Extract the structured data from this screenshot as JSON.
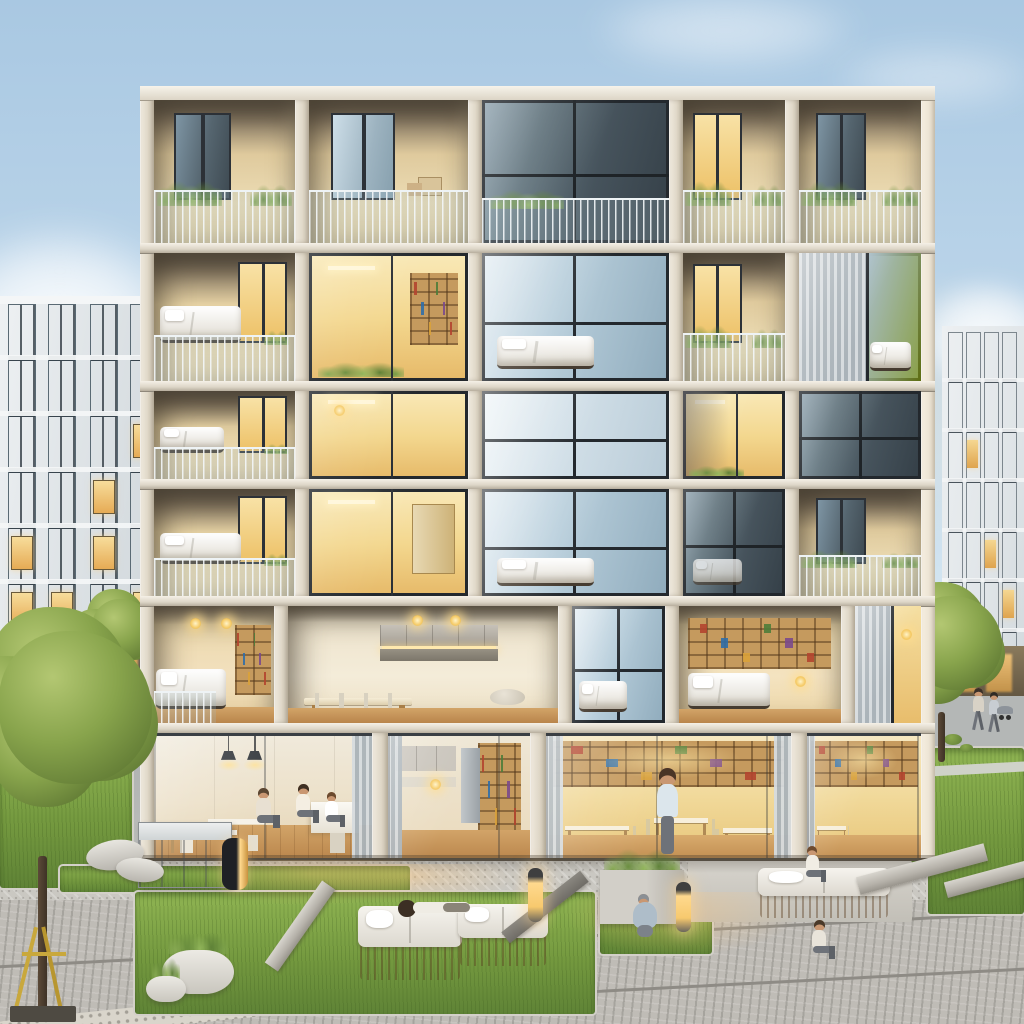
{
  "meta": {
    "description": "Dusk architectural visualization: modular apartment block with lit cutaway interiors, neighbor buildings, plaza with lawns, daybeds, planters and people",
    "canvas": {
      "width": 1024,
      "height": 1024
    }
  },
  "palette": {
    "sky_top": "#a9c8e2",
    "sky_mid": "#c6dcee",
    "sky_horizon": "#e9f1f6",
    "cloud": "#ffffff",
    "concrete_sun": "#f1ebdf",
    "concrete": "#e2dbcd",
    "concrete_shade": "#b9b1a2",
    "slab_edge": "#8f887b",
    "recess_wall": "#e9d7ac",
    "recess_ceiling": "#6a6052",
    "glass_sky": "#bdd2de",
    "glass_dark": "#414e58",
    "frame": "#23282d",
    "warm_light": "#f2d48a",
    "warm_deep": "#e2a74e",
    "lamp_glow": "#ffe2a0",
    "wood": "#c59a5e",
    "wood_dark": "#a87e47",
    "plant": "#6c8f45",
    "plant_light": "#8fae56",
    "grass": "#74993f",
    "grass_bright": "#90b553",
    "paver": "#cac8c2",
    "paver_light": "#d8d5ce",
    "cobble": "#bfbcb6",
    "bed": "#f5f4f0",
    "curtain": "#d6dbde",
    "curtain_dark": "#aab3b9",
    "skin": "#c99772",
    "pants": "#6e7279",
    "book_colors": [
      "#b2452f",
      "#2f6ea8",
      "#d9a23a",
      "#4e7d3a",
      "#7a4a8c",
      "#b2452f"
    ]
  },
  "sky": {
    "clouds": [
      {
        "x": -70,
        "y": 225,
        "w": 260,
        "h": 200,
        "blur": 16,
        "o": 0.95
      },
      {
        "x": -40,
        "y": 415,
        "w": 130,
        "h": 95,
        "blur": 14,
        "o": 0.8
      },
      {
        "x": 590,
        "y": -10,
        "w": 270,
        "h": 75,
        "blur": 16,
        "o": 0.5
      },
      {
        "x": 830,
        "y": 45,
        "w": 210,
        "h": 60,
        "blur": 16,
        "o": 0.42
      },
      {
        "x": 915,
        "y": 280,
        "w": 140,
        "h": 105,
        "blur": 10,
        "o": 0.9
      }
    ]
  },
  "neighbors": {
    "left": {
      "x": 0,
      "y": 296,
      "w": 158,
      "h": 396,
      "strips": [
        8,
        48,
        90,
        130
      ],
      "strip_w": 26,
      "floor_h": 56,
      "lit": [
        [
          0,
          4
        ],
        [
          0,
          5
        ],
        [
          1,
          5
        ],
        [
          2,
          3
        ],
        [
          2,
          4
        ],
        [
          2,
          6
        ],
        [
          3,
          2
        ],
        [
          3,
          5
        ]
      ]
    },
    "right": {
      "x": 942,
      "y": 326,
      "w": 82,
      "h": 376,
      "strips": [
        6,
        24,
        42,
        60
      ],
      "strip_w": 13,
      "floor_h": 50,
      "lit": [
        [
          1,
          2
        ],
        [
          2,
          4
        ],
        [
          3,
          5
        ],
        [
          0,
          6
        ]
      ]
    }
  },
  "building": {
    "x": 140,
    "y": 86,
    "w": 795,
    "parapet_h": 14,
    "pier_w": 14,
    "slab_h": 10,
    "rows": [
      {
        "h": 143,
        "cells": [
          {
            "type": "balcony",
            "w": 131,
            "door": "dark",
            "plants": true
          },
          {
            "type": "balcony",
            "w": 148,
            "door": "light",
            "props": true
          },
          {
            "type": "window-dark",
            "w": 174,
            "rail": true
          },
          {
            "type": "balcony",
            "w": 95,
            "door": "warm",
            "plants": true
          },
          {
            "type": "balcony",
            "w": 114,
            "door": "dark",
            "plants": true
          }
        ]
      },
      {
        "h": 128,
        "cells": [
          {
            "type": "balcony-bed",
            "w": 131,
            "door": "warm"
          },
          {
            "type": "window-warm",
            "w": 148,
            "shelf": true,
            "plantsill": true
          },
          {
            "type": "window-bright",
            "w": 174,
            "bed": true
          },
          {
            "type": "balcony",
            "w": 95,
            "door": "warm",
            "plants": true
          },
          {
            "type": "window-curtain",
            "w": 114,
            "bed": true
          }
        ]
      },
      {
        "h": 88,
        "cells": [
          {
            "type": "balcony-bed",
            "w": 131,
            "small": true,
            "door": "warm"
          },
          {
            "type": "window-warm",
            "w": 148,
            "lamp": true
          },
          {
            "type": "window-bright",
            "w": 174,
            "white": true
          },
          {
            "type": "window-warm",
            "w": 95,
            "plantsill": true,
            "dark": true
          },
          {
            "type": "window-dark",
            "w": 114
          }
        ]
      },
      {
        "h": 107,
        "cells": [
          {
            "type": "balcony-bed",
            "w": 131,
            "door": "warm"
          },
          {
            "type": "window-warm",
            "w": 148,
            "wardrobe": true
          },
          {
            "type": "window-bright",
            "w": 174,
            "bed": true
          },
          {
            "type": "window-dark",
            "w": 95,
            "bed": true
          },
          {
            "type": "balcony",
            "w": 114,
            "door": "dark",
            "plants": true
          }
        ]
      },
      {
        "h": 117,
        "cells": [
          {
            "type": "cut-bedroom",
            "w": 120
          },
          {
            "type": "cut-kitchen",
            "w": 269
          },
          {
            "type": "window-bright",
            "w": 93,
            "bed": true
          },
          {
            "type": "cut-library",
            "w": 162
          },
          {
            "type": "window-curtain",
            "w": 66,
            "warm": true
          }
        ]
      }
    ],
    "ground": {
      "h": 128,
      "pier_w": 16,
      "bays": [
        {
          "type": "dining",
          "w": 230
        },
        {
          "type": "kitchen",
          "w": 150
        },
        {
          "type": "library",
          "w": 260
        },
        {
          "type": "library",
          "w": 120,
          "narrow": true
        }
      ]
    }
  },
  "plaza": {
    "grass": [
      {
        "x": 0,
        "y": 742,
        "w": 132,
        "h": 146
      },
      {
        "x": 60,
        "y": 866,
        "w": 350,
        "h": 26
      },
      {
        "x": 135,
        "y": 892,
        "w": 460,
        "h": 122
      },
      {
        "x": 600,
        "y": 896,
        "w": 112,
        "h": 58
      },
      {
        "x": 690,
        "y": 838,
        "w": 334,
        "h": 26
      },
      {
        "x": 928,
        "y": 748,
        "w": 96,
        "h": 166
      }
    ],
    "pads": [
      {
        "x": 688,
        "y": 860,
        "w": 224,
        "h": 62
      }
    ],
    "daybeds": [
      {
        "x": 358,
        "y": 906,
        "w": 104,
        "h": 74
      },
      {
        "x": 458,
        "y": 904,
        "w": 90,
        "h": 62
      },
      {
        "x": 758,
        "y": 868,
        "w": 132,
        "h": 50
      }
    ],
    "beams": [
      {
        "x": 250,
        "y": 918,
        "w": 100,
        "h": 16,
        "rot": -55
      },
      {
        "x": 495,
        "y": 900,
        "w": 100,
        "h": 14,
        "rot": -38,
        "dark": true
      },
      {
        "x": 856,
        "y": 860,
        "w": 132,
        "h": 18,
        "rot": -15
      },
      {
        "x": 944,
        "y": 868,
        "w": 110,
        "h": 16,
        "rot": -15
      }
    ],
    "planter_bowls": [
      {
        "x": 162,
        "y": 950,
        "w": 72,
        "h": 44
      },
      {
        "x": 146,
        "y": 976,
        "w": 40,
        "h": 26
      }
    ],
    "planter_box": {
      "x": 600,
      "y": 870,
      "w": 84,
      "h": 54
    },
    "glass_box": {
      "x": 138,
      "y": 822,
      "w": 92,
      "h": 64
    },
    "dark_bin": {
      "x": 222,
      "y": 838,
      "w": 26,
      "h": 52
    },
    "stones": [
      {
        "x": 86,
        "y": 840,
        "w": 58,
        "h": 30,
        "rot": -8
      },
      {
        "x": 116,
        "y": 858,
        "w": 48,
        "h": 24,
        "rot": 6
      }
    ],
    "bollards": [
      {
        "x": 528,
        "y": 868,
        "h": 54
      },
      {
        "x": 676,
        "y": 882,
        "h": 50
      }
    ],
    "glows": [
      {
        "x": 180,
        "y": 860,
        "w": 260,
        "h": 46
      },
      {
        "x": 560,
        "y": 892,
        "w": 240,
        "h": 64
      },
      {
        "x": 300,
        "y": 864,
        "w": 220,
        "h": 40
      }
    ],
    "channels": [
      {
        "y": 938
      },
      {
        "y": 994
      }
    ],
    "tactile": {
      "x": -30,
      "y": 1002,
      "w": 430,
      "h": 22,
      "rot": -6
    },
    "lawn_path": {
      "x": 926,
      "y": 764,
      "w": 100,
      "h": 10
    },
    "bushes": [
      {
        "x": 944,
        "y": 734,
        "w": 18,
        "h": 11
      },
      {
        "x": 960,
        "y": 744,
        "w": 13,
        "h": 8
      }
    ]
  },
  "trees": [
    {
      "cx": 58,
      "cy": 712,
      "r": 98,
      "trunk": {
        "x": 38,
        "y": 856,
        "w": 9,
        "h": 158
      },
      "stake": true
    },
    {
      "cx": 116,
      "cy": 632,
      "r": 40,
      "trunk": {
        "x": 112,
        "y": 680,
        "w": 5,
        "h": 58
      },
      "stake": false
    },
    {
      "cx": 944,
      "cy": 646,
      "r": 60,
      "trunk": {
        "x": 938,
        "y": 712,
        "w": 7,
        "h": 50
      },
      "stake": false
    }
  ],
  "people": [
    {
      "x": 250,
      "y": 788,
      "pose": "sit",
      "h": 56,
      "shirt": "#e8e0d2",
      "hair": "#5a4632"
    },
    {
      "x": 290,
      "y": 784,
      "pose": "sit",
      "h": 54,
      "shirt": "#f4eee2",
      "hair": "#3e2f22"
    },
    {
      "x": 320,
      "y": 792,
      "pose": "sit",
      "h": 48,
      "shirt": "#ffffff",
      "hair": "#6b4a2e"
    },
    {
      "x": 646,
      "y": 768,
      "pose": "stand",
      "h": 88,
      "shirt": "#dce6ec",
      "hair": "#4a3526"
    },
    {
      "x": 800,
      "y": 846,
      "pose": "sit",
      "h": 50,
      "shirt": "#f1ede4",
      "hair": "#6d4b2f"
    },
    {
      "x": 398,
      "y": 898,
      "pose": "lie",
      "h": 22,
      "w": 72,
      "shirt": "#efece4",
      "hair": "#3c2f24"
    },
    {
      "x": 630,
      "y": 894,
      "pose": "crouch",
      "h": 56,
      "shirt": "#aebdc9",
      "hair": "#8a8f94"
    },
    {
      "x": 806,
      "y": 920,
      "pose": "sit",
      "h": 54,
      "shirt": "#e9e4da",
      "hair": "#4a3a2a"
    },
    {
      "x": 968,
      "y": 688,
      "pose": "walk",
      "h": 44,
      "shirt": "#d8d2c6",
      "hair": "#3a3028"
    },
    {
      "x": 984,
      "y": 692,
      "pose": "walk",
      "h": 42,
      "shirt": "#c8cdd2",
      "hair": "#2f2a24"
    }
  ],
  "stroller": {
    "x": 997,
    "y": 706,
    "w": 16,
    "h": 14
  }
}
